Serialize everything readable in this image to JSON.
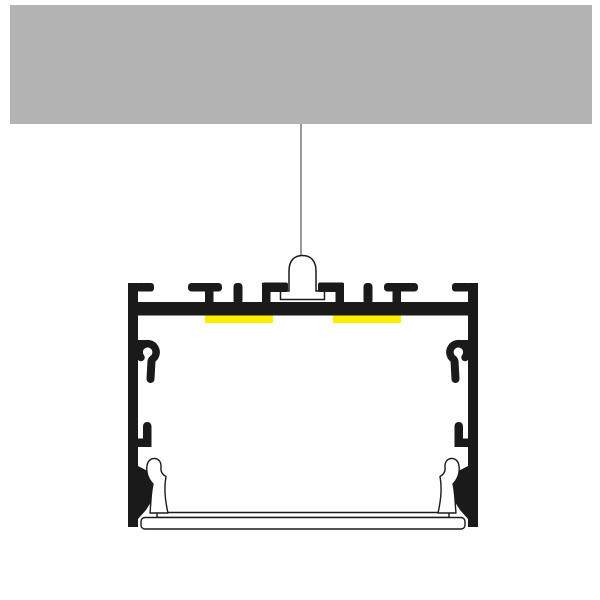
{
  "title": "LED aluminium profile — ceiling suspension mounting diagram",
  "colors": {
    "background": "#ffffff",
    "ceiling": "#b3b3b3",
    "wire": "#999999",
    "profile_black": "#1a1a1a",
    "led_strip_yellow": "#ffed00",
    "white_part": "#ffffff"
  },
  "components": {
    "ceiling": "ceiling-slab",
    "wire": "suspension-wire",
    "mount": "suspension-bell-mount",
    "profile": "aluminium-profile-cross-section",
    "led_left": "led-strip-left",
    "led_right": "led-strip-right",
    "diffuser": "snap-in-diffuser-cover"
  }
}
